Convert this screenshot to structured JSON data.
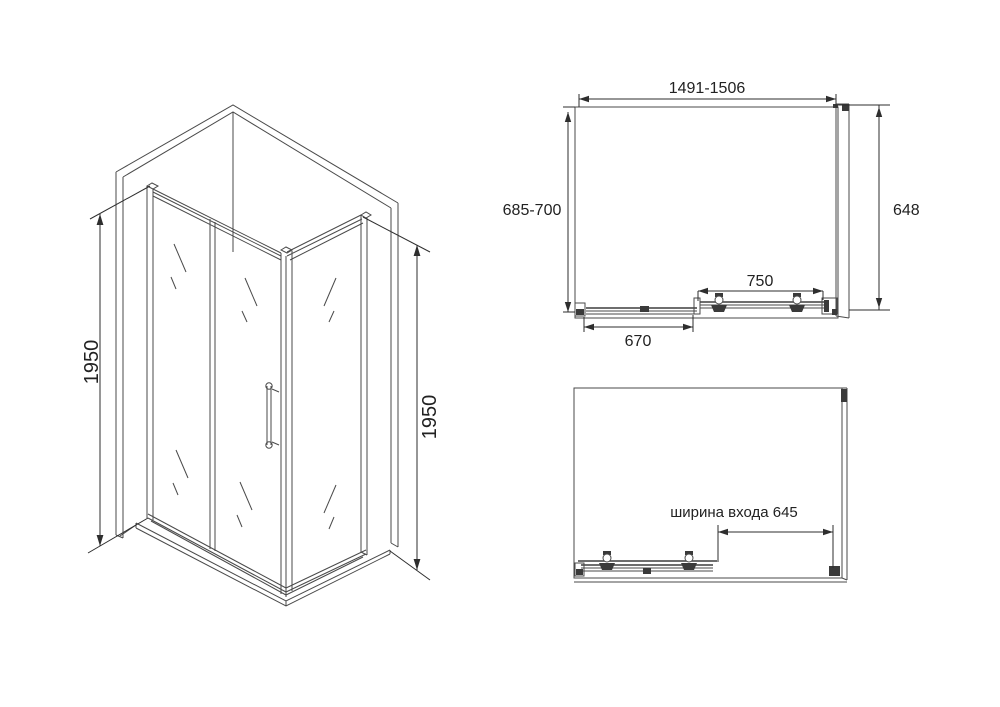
{
  "drawing": {
    "type": "shower-enclosure-dimension-drawing",
    "isometric": {
      "height_left": "1950",
      "height_right": "1950"
    },
    "plan_closed": {
      "width_range": "1491-1506",
      "depth_range": "685-700",
      "side_panel": "648",
      "door_width": "750",
      "fixed_panel": "670"
    },
    "plan_open": {
      "entrance_width_label": "ширина входа 645"
    }
  },
  "colors": {
    "line": "#4a4a4a",
    "dimension_line": "#2e2e2e",
    "text": "#222222",
    "dark_fill": "#3a3a3a",
    "background": "#ffffff"
  }
}
